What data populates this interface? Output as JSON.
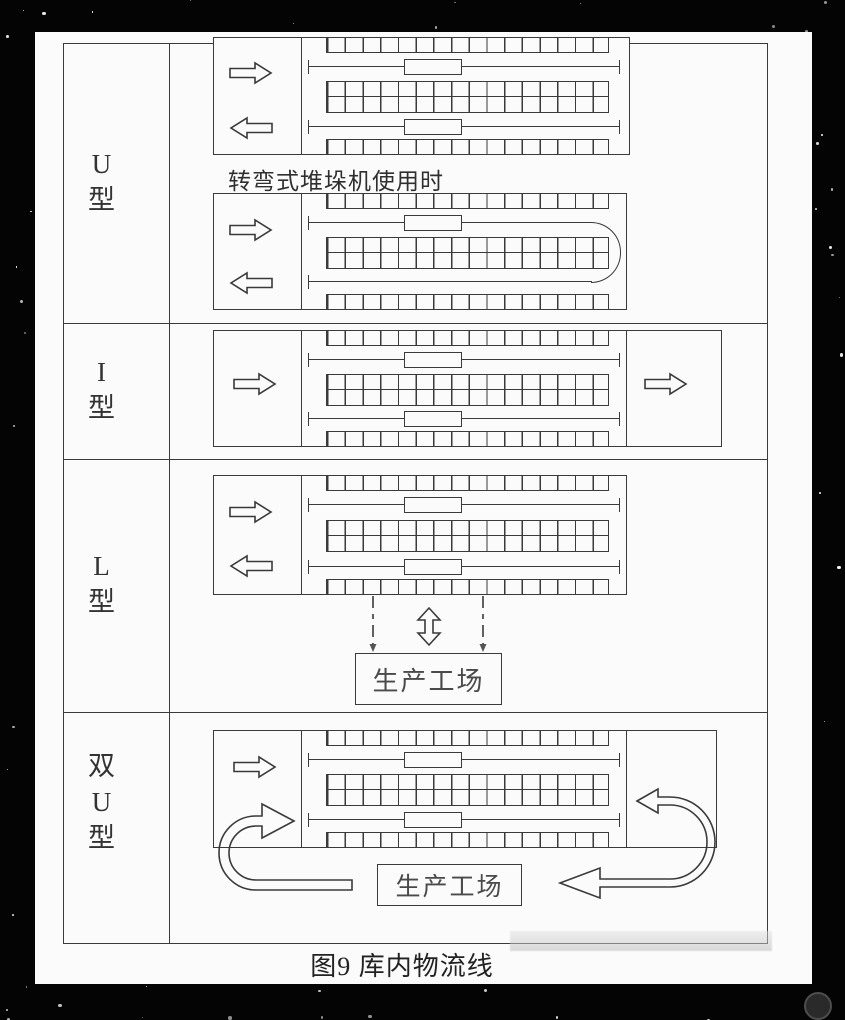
{
  "figure": {
    "caption": "图9  库内物流线",
    "rows": [
      {
        "id": "u-type",
        "label_lines": [
          "U",
          "型"
        ],
        "note": "转弯式堆垛机使用时"
      },
      {
        "id": "i-type",
        "label_lines": [
          "I",
          "型"
        ]
      },
      {
        "id": "l-type",
        "label_lines": [
          "L",
          "型"
        ],
        "workshop_label": "生产工场"
      },
      {
        "id": "double-u-type",
        "label_lines": [
          "双",
          "U",
          "型"
        ],
        "workshop_label": "生产工场"
      }
    ],
    "icons": {
      "flow_in": "block-arrow-right",
      "flow_out": "block-arrow-left",
      "transfer": "double-headed-vertical-arrow",
      "loop_left": "curved-u-arrow-left",
      "loop_right": "curved-u-arrow-right"
    },
    "colors": {
      "line": "#3a3a3a",
      "paper": "#fbfbfb",
      "background": "#000000"
    }
  }
}
